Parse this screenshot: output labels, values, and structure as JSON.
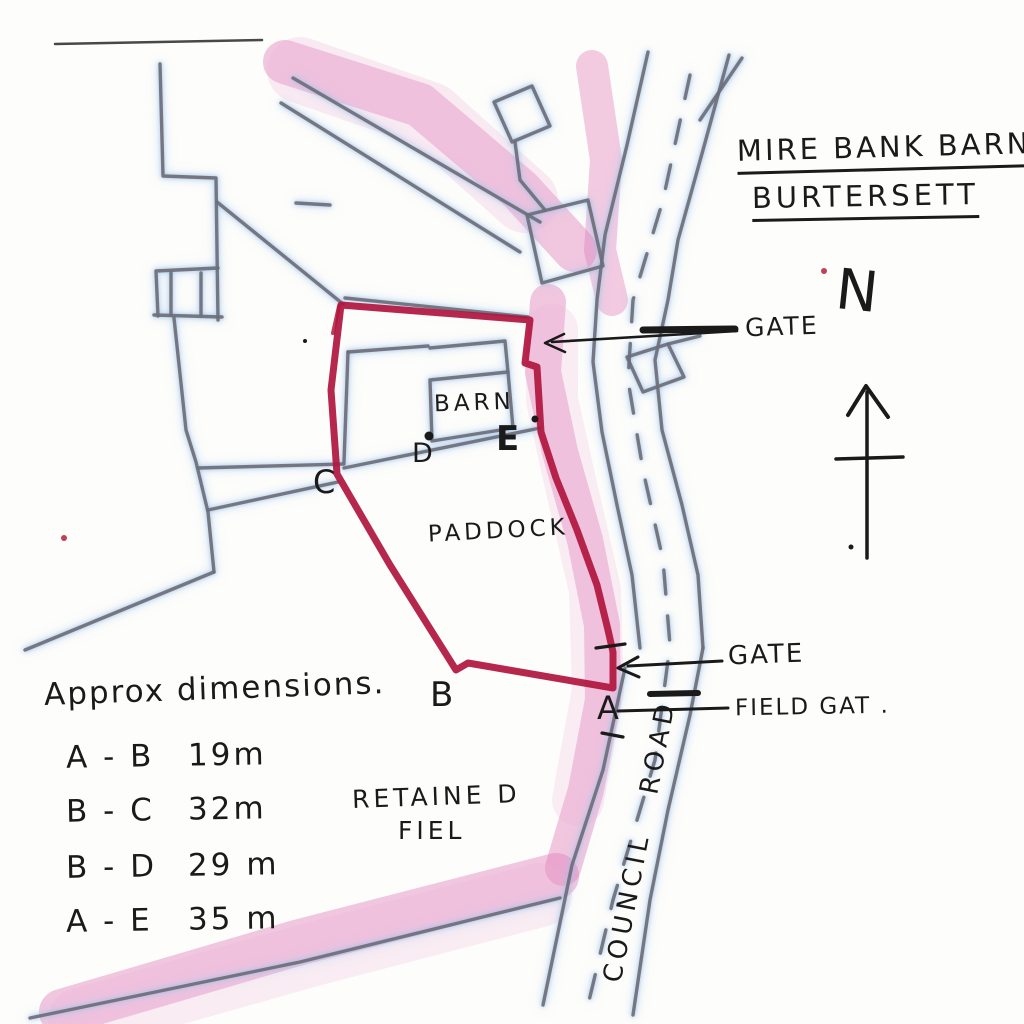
{
  "document": {
    "title_line1": "MIRE BANK BARN",
    "title_line2": "BURTERSETT"
  },
  "map_labels": {
    "barn": "BARN",
    "paddock": "PADDOCK",
    "retained_field_line1": "RETAINE D",
    "retained_field_line2": "FIEL",
    "council_road": "COUNCIL ROAD",
    "gate_upper": "GATE",
    "gate_lower": "GATE",
    "field_gate": "FIELD GAT .",
    "north": "N"
  },
  "boundary_points": {
    "a": "A",
    "b": "B",
    "c": "C",
    "d": "D",
    "e": "E"
  },
  "dimensions": {
    "heading": "Approx dimensions.",
    "rows": [
      {
        "pair": "A - B",
        "value": "19m"
      },
      {
        "pair": "B - C",
        "value": "32m"
      },
      {
        "pair": "B - D",
        "value": "29 m"
      },
      {
        "pair": "A - E",
        "value": "35 m"
      }
    ]
  },
  "colors": {
    "boundary_red": "#b0173f",
    "highlight_pink": "#e07ab8",
    "pencil_grey": "#6f6f78",
    "pencil_halo_blue": "#aecdea",
    "ink_black": "#1a1a1a"
  }
}
